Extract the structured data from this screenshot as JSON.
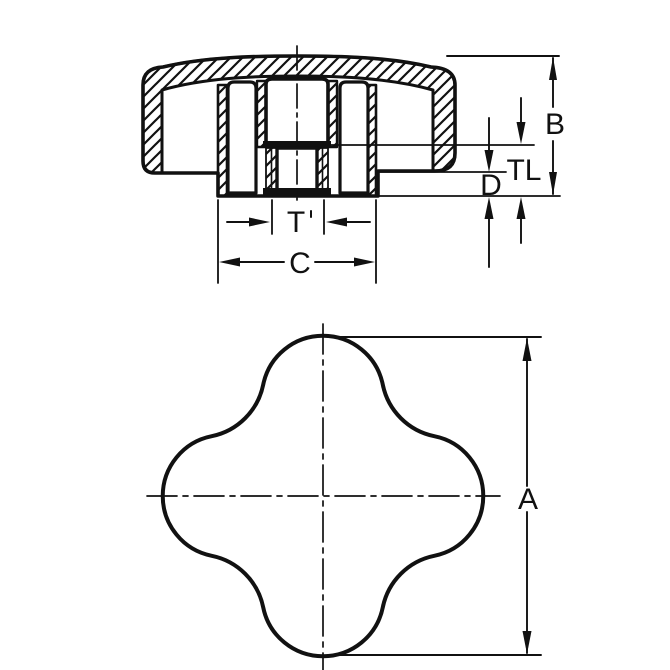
{
  "drawing": {
    "background": "#ffffff",
    "line_color": "#111111",
    "views": [
      {
        "id": "section",
        "name": "cross-section-view"
      },
      {
        "id": "plan",
        "name": "four-lobe-plan-view"
      }
    ],
    "dimension_labels": {
      "B": "B",
      "TL": "TL",
      "D": "D",
      "T": "T",
      "C": "C",
      "A": "A"
    }
  }
}
